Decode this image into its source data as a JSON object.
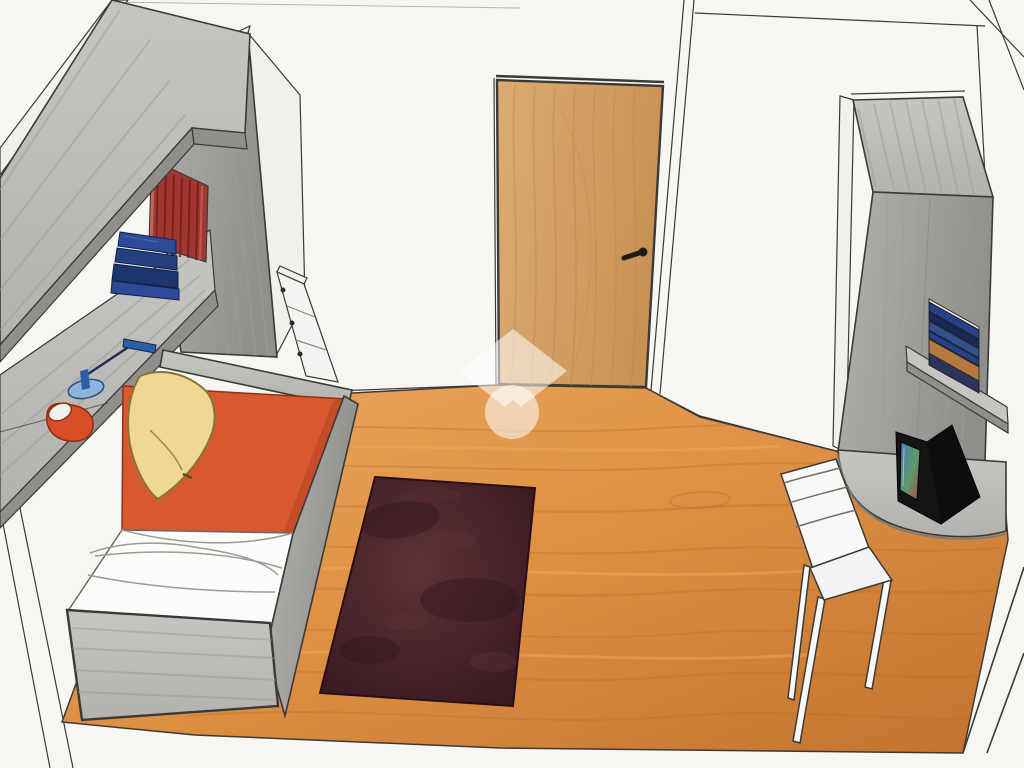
{
  "scene": {
    "type": "3d-interior-rendering",
    "room": "bedroom perspective drawing",
    "objects": [
      "overhead-bridge-cabinet",
      "wall-shelf-upper",
      "wall-shelf-lower",
      "red-books-row",
      "blue-folded-stack",
      "desk-lamp-blue",
      "red-mug",
      "drawer-unit",
      "single-bed",
      "orange-bedspread",
      "yellow-pillow",
      "white-duvet",
      "bed-footboard",
      "wooden-door",
      "door-handle",
      "area-rug",
      "wood-floor",
      "tall-wardrobe-right",
      "wall-shelf-with-media",
      "corner-desk",
      "crt-tv",
      "white-chair",
      "watermark-logo"
    ]
  },
  "colors": {
    "paper": "#f7f6f3",
    "outline": "#3b3a37",
    "line_light": "#9a9994",
    "floor_light": "#eba95c",
    "floor_base": "#dd8f43",
    "floor_dark": "#c2722d",
    "floor_grain": "#b96a28",
    "door_light": "#dcab70",
    "door_dark": "#c89254",
    "door_grain": "#bc8848",
    "rug_base": "#4a252b",
    "rug_dark": "#33161d",
    "rug_light": "#5e3236",
    "gray_light": "#c6c5c2",
    "gray_mid": "#b3b2af",
    "gray_dark": "#908f8c",
    "gray_edge": "#7d7c79",
    "gray_grain": "#9d9c99",
    "white_face": "#f1f0ed",
    "bed_orange": "#d85830",
    "bed_orange_dark": "#b84422",
    "pillow_yellow": "#eed893",
    "pillow_edge": "#8a7434",
    "bedding_white": "#fcfcfb",
    "book_red": "#a13730",
    "book_red_dark": "#6f211e",
    "book_pink": "#c96a5e",
    "stack_blue": "#2d4a97",
    "stack_blue_mid": "#24407f",
    "stack_blue_dark": "#1c3470",
    "lamp_blue": "#8cb4dc",
    "lamp_dark_blue": "#2d5fa8",
    "mug_red": "#d84e28",
    "tv_black": "#141417",
    "tv_side": "#0d0d10",
    "screen_blue": "#4a79b8",
    "screen_green": "#5e9a67",
    "screen_red": "#a84848",
    "chair_white": "#f8f8f6",
    "media_navy": "#24418a",
    "media_navy_dark": "#16295e",
    "media_blue": "#33508f",
    "media_cover": "#b5793f",
    "watermark": "rgba(255,255,255,0.55)"
  }
}
